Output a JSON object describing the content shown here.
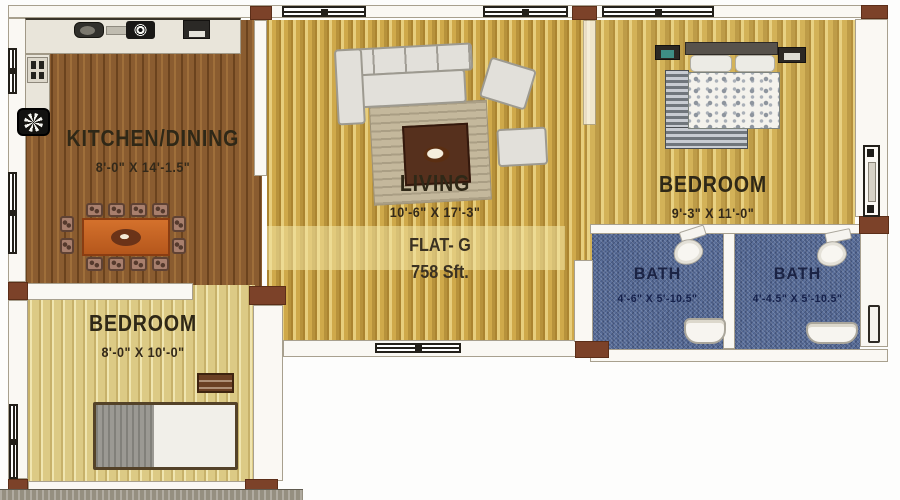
{
  "plan": {
    "flat": {
      "name": "FLAT- G",
      "area": "758 Sft."
    },
    "rooms": {
      "kitchen": {
        "name": "KITCHEN/DINING",
        "dims": "8'-0\" X 14'-1.5\""
      },
      "living": {
        "name": "LIVING",
        "dims": "10'-6\" X 17'-3\""
      },
      "bedroom1": {
        "name": "BEDROOM",
        "dims": "9'-3\" X 11'-0\""
      },
      "bedroom2": {
        "name": "BEDROOM",
        "dims": "8'-0\" X 10'-0\""
      },
      "bath1": {
        "name": "BATH",
        "dims": "4'-6\" X 5'-10.5\""
      },
      "bath2": {
        "name": "BATH",
        "dims": "4'-4.5\" X 5'-10.5\""
      }
    },
    "colors": {
      "kitchen_wood": "#8a5c30",
      "living_wood": "#cfa94a",
      "bedroom_wood": "#d3b258",
      "bedroom2_wood": "#dcca85",
      "bath_denim": "#5a6f9b",
      "column_brown": "#7c4229",
      "dining_table_orange": "#c96a2a"
    },
    "icons": [
      "window-icon",
      "door-icon",
      "column",
      "dining-table",
      "dining-chair",
      "sofa",
      "armchair",
      "coffee-table",
      "rug",
      "double-bed",
      "single-bed",
      "nightstand",
      "pillow",
      "toilet-icon",
      "washbasin-icon",
      "kitchen-sink-icon",
      "stove-burner-icon",
      "hob-icon",
      "fridge-icon",
      "cooktop-star-icon",
      "duct-pipe"
    ]
  }
}
